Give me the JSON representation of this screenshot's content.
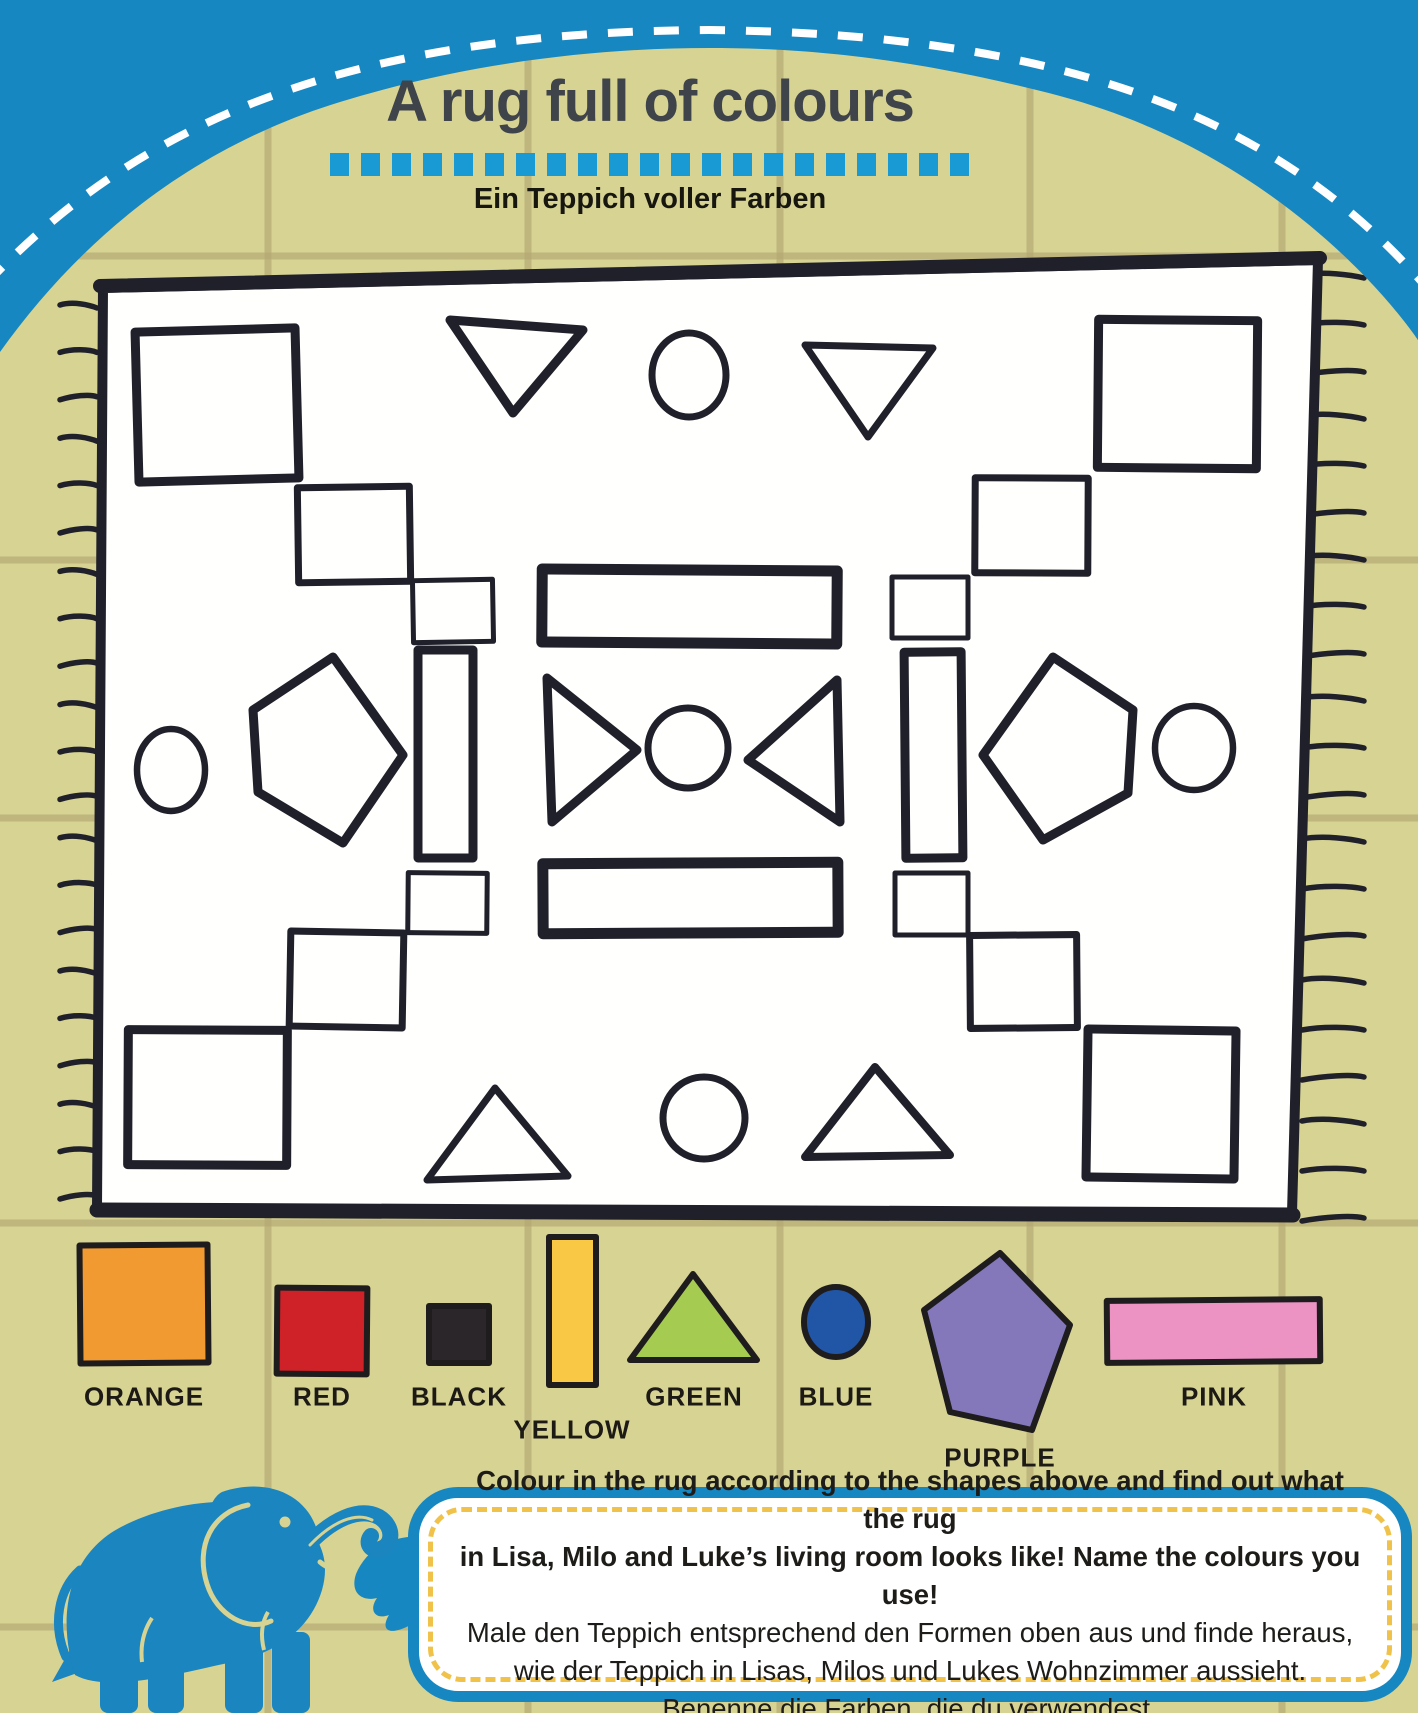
{
  "page": {
    "title": "A rug full of colours",
    "subtitle": "Ein Teppich voller Farben"
  },
  "header": {
    "dash_count": 21
  },
  "colors": {
    "background_khaki": "#d6d393",
    "tile_grout": "#b4a772",
    "header_blue": "#1787c1",
    "dash_blue": "#1a9ad4",
    "title_gray": "#3f434a",
    "ink": "#20202a",
    "rug_fill": "#fffffe",
    "bubble_border_blue": "#1787c1",
    "bubble_dash_yellow": "#f0c24a",
    "elephant_blue": "#1b85bf",
    "swatch_orange": "#f09a31",
    "swatch_red": "#ce2128",
    "swatch_black": "#2a2629",
    "swatch_yellow": "#f9c945",
    "swatch_green": "#a5cb51",
    "swatch_blue": "#2156a7",
    "swatch_purple": "#8478bb",
    "swatch_pink": "#ec93c4"
  },
  "background": {
    "grout_vertical_x": [
      268,
      528,
      780,
      1030,
      1282
    ],
    "grout_horizontal_y": [
      256,
      560,
      818,
      1223,
      1627
    ]
  },
  "rug": {
    "outline": [
      [
        103,
        288
      ],
      [
        1318,
        260
      ],
      [
        1292,
        1213
      ],
      [
        97,
        1208
      ]
    ],
    "stroke_width": 10,
    "shapes": [
      {
        "name": "large-square-top-left",
        "type": "rect",
        "x": 137,
        "y": 330,
        "w": 160,
        "h": 150,
        "rot": -1.5,
        "sw": 9
      },
      {
        "name": "triangle-down-top-left",
        "type": "poly",
        "pts": [
          [
            450,
            320
          ],
          [
            583,
            330
          ],
          [
            513,
            413
          ]
        ],
        "sw": 9
      },
      {
        "name": "circle-top-center",
        "type": "ellipse",
        "cx": 689,
        "cy": 375,
        "rx": 37,
        "ry": 42,
        "sw": 7
      },
      {
        "name": "triangle-down-top-right",
        "type": "poly",
        "pts": [
          [
            805,
            345
          ],
          [
            933,
            348
          ],
          [
            868,
            437
          ]
        ],
        "sw": 7
      },
      {
        "name": "large-square-top-right",
        "type": "rect",
        "x": 1098,
        "y": 320,
        "w": 159,
        "h": 148,
        "rot": 0.5,
        "sw": 9
      },
      {
        "name": "medium-square-upper-left",
        "type": "rect",
        "x": 298,
        "y": 487,
        "w": 112,
        "h": 95,
        "rot": -0.8,
        "sw": 7
      },
      {
        "name": "medium-square-upper-right",
        "type": "rect",
        "x": 975,
        "y": 478,
        "w": 113,
        "h": 95,
        "rot": 0.3,
        "sw": 7
      },
      {
        "name": "small-square-left-top",
        "type": "rect",
        "x": 413,
        "y": 580,
        "w": 80,
        "h": 62,
        "rot": -1,
        "sw": 5
      },
      {
        "name": "rectangle-center-top",
        "type": "rect",
        "x": 542,
        "y": 570,
        "w": 295,
        "h": 73,
        "rot": 0.4,
        "sw": 11
      },
      {
        "name": "small-square-right-top",
        "type": "rect",
        "x": 892,
        "y": 577,
        "w": 76,
        "h": 61,
        "rot": 0,
        "sw": 5
      },
      {
        "name": "vertical-rectangle-left",
        "type": "rect",
        "x": 418,
        "y": 650,
        "w": 55,
        "h": 208,
        "rot": 0,
        "sw": 9
      },
      {
        "name": "vertical-rectangle-right",
        "type": "rect",
        "x": 905,
        "y": 652,
        "w": 57,
        "h": 206,
        "rot": -0.5,
        "sw": 9
      },
      {
        "name": "circle-middle-left",
        "type": "ellipse",
        "cx": 171,
        "cy": 770,
        "rx": 34,
        "ry": 41,
        "sw": 6.5
      },
      {
        "name": "pentagon-left",
        "type": "poly",
        "pts": [
          [
            333,
            657
          ],
          [
            403,
            755
          ],
          [
            343,
            843
          ],
          [
            258,
            792
          ],
          [
            253,
            710
          ]
        ],
        "sw": 9
      },
      {
        "name": "triangle-right-center",
        "type": "poly",
        "pts": [
          [
            547,
            678
          ],
          [
            552,
            822
          ],
          [
            637,
            750
          ]
        ],
        "sw": 9
      },
      {
        "name": "circle-center",
        "type": "ellipse",
        "cx": 688,
        "cy": 748,
        "rx": 40,
        "ry": 40,
        "sw": 7
      },
      {
        "name": "triangle-left-center",
        "type": "poly",
        "pts": [
          [
            837,
            680
          ],
          [
            840,
            822
          ],
          [
            748,
            760
          ]
        ],
        "sw": 9
      },
      {
        "name": "pentagon-right",
        "type": "poly",
        "pts": [
          [
            1053,
            657
          ],
          [
            1133,
            710
          ],
          [
            1128,
            793
          ],
          [
            1043,
            840
          ],
          [
            983,
            755
          ]
        ],
        "sw": 9
      },
      {
        "name": "circle-middle-right",
        "type": "ellipse",
        "cx": 1194,
        "cy": 748,
        "rx": 39,
        "ry": 42,
        "sw": 6.5
      },
      {
        "name": "small-square-left-bottom",
        "type": "rect",
        "x": 408,
        "y": 873,
        "w": 79,
        "h": 60,
        "rot": 0.5,
        "sw": 5
      },
      {
        "name": "rectangle-center-bottom",
        "type": "rect",
        "x": 543,
        "y": 863,
        "w": 295,
        "h": 70,
        "rot": -0.3,
        "sw": 11
      },
      {
        "name": "small-square-right-bottom",
        "type": "rect",
        "x": 895,
        "y": 873,
        "w": 73,
        "h": 62,
        "rot": 0,
        "sw": 5
      },
      {
        "name": "medium-square-lower-left",
        "type": "rect",
        "x": 290,
        "y": 932,
        "w": 113,
        "h": 95,
        "rot": 1,
        "sw": 7
      },
      {
        "name": "medium-square-lower-right",
        "type": "rect",
        "x": 970,
        "y": 935,
        "w": 107,
        "h": 93,
        "rot": -0.5,
        "sw": 7
      },
      {
        "name": "large-square-bottom-left",
        "type": "rect",
        "x": 128,
        "y": 1030,
        "w": 159,
        "h": 135,
        "rot": 0.3,
        "sw": 9
      },
      {
        "name": "triangle-up-bottom-left",
        "type": "poly",
        "pts": [
          [
            495,
            1088
          ],
          [
            568,
            1176
          ],
          [
            427,
            1180
          ]
        ],
        "sw": 7
      },
      {
        "name": "circle-bottom-center",
        "type": "ellipse",
        "cx": 704,
        "cy": 1118,
        "rx": 41,
        "ry": 41,
        "sw": 7
      },
      {
        "name": "triangle-up-bottom-right",
        "type": "poly",
        "pts": [
          [
            875,
            1067
          ],
          [
            950,
            1155
          ],
          [
            805,
            1157
          ]
        ],
        "sw": 8
      },
      {
        "name": "large-square-bottom-right",
        "type": "rect",
        "x": 1087,
        "y": 1030,
        "w": 148,
        "h": 148,
        "rot": 0.8,
        "sw": 9
      }
    ]
  },
  "fringe": {
    "left": {
      "x1": 60,
      "x2": 97,
      "y_start": 308,
      "y_end": 1196,
      "count": 21
    },
    "right": {
      "x1": 1302,
      "x2": 1364,
      "y_start": 278,
      "y_end": 1218,
      "count": 21
    }
  },
  "legend": {
    "items": [
      {
        "id": "orange",
        "label": "ORANGE",
        "color": "#f09a31",
        "shape": {
          "type": "rect",
          "x": 80,
          "y": 1245,
          "w": 128,
          "h": 118,
          "rot": -0.5
        },
        "label_pos": {
          "x": 144,
          "y": 1397
        }
      },
      {
        "id": "red",
        "label": "RED",
        "color": "#ce2128",
        "shape": {
          "type": "rect",
          "x": 277,
          "y": 1288,
          "w": 90,
          "h": 86,
          "rot": 0.5
        },
        "label_pos": {
          "x": 322,
          "y": 1397
        }
      },
      {
        "id": "black",
        "label": "BLACK",
        "color": "#2a2629",
        "shape": {
          "type": "rect",
          "x": 429,
          "y": 1306,
          "w": 60,
          "h": 57,
          "rot": 0
        },
        "label_pos": {
          "x": 459,
          "y": 1397
        }
      },
      {
        "id": "yellow",
        "label": "YELLOW",
        "color": "#f9c945",
        "shape": {
          "type": "rect",
          "x": 549,
          "y": 1237,
          "w": 47,
          "h": 148,
          "rot": 0
        },
        "label_pos": {
          "x": 572,
          "y": 1430
        }
      },
      {
        "id": "green",
        "label": "GREEN",
        "color": "#a5cb51",
        "shape": {
          "type": "poly",
          "pts": [
            [
              693,
              1274
            ],
            [
              757,
              1360
            ],
            [
              630,
              1360
            ]
          ]
        },
        "label_pos": {
          "x": 694,
          "y": 1397
        }
      },
      {
        "id": "blue",
        "label": "BLUE",
        "color": "#2156a7",
        "shape": {
          "type": "ellipse",
          "cx": 836,
          "cy": 1322,
          "rx": 32,
          "ry": 35
        },
        "label_pos": {
          "x": 836,
          "y": 1397
        }
      },
      {
        "id": "purple",
        "label": "PURPLE",
        "color": "#8478bb",
        "shape": {
          "type": "poly",
          "pts": [
            [
              1000,
              1253
            ],
            [
              1070,
              1325
            ],
            [
              1032,
              1430
            ],
            [
              950,
              1412
            ],
            [
              924,
              1310
            ]
          ]
        },
        "label_pos": {
          "x": 1000,
          "y": 1458
        }
      },
      {
        "id": "pink",
        "label": "PINK",
        "color": "#ec93c4",
        "shape": {
          "type": "rect",
          "x": 1107,
          "y": 1300,
          "w": 213,
          "h": 62,
          "rot": -0.5
        },
        "label_pos": {
          "x": 1214,
          "y": 1397
        }
      }
    ]
  },
  "instructions": {
    "lines": [
      "Colour in the rug according to the shapes above and find out what the rug",
      "in Lisa, Milo and Luke’s living room looks like! Name the colours you use!",
      "Male den Teppich entsprechend den Formen oben aus und finde heraus,",
      "wie der Teppich in Lisas, Milos und Lukes Wohnzimmer aussieht.",
      "Benenne die Farben, die du verwendest."
    ]
  }
}
